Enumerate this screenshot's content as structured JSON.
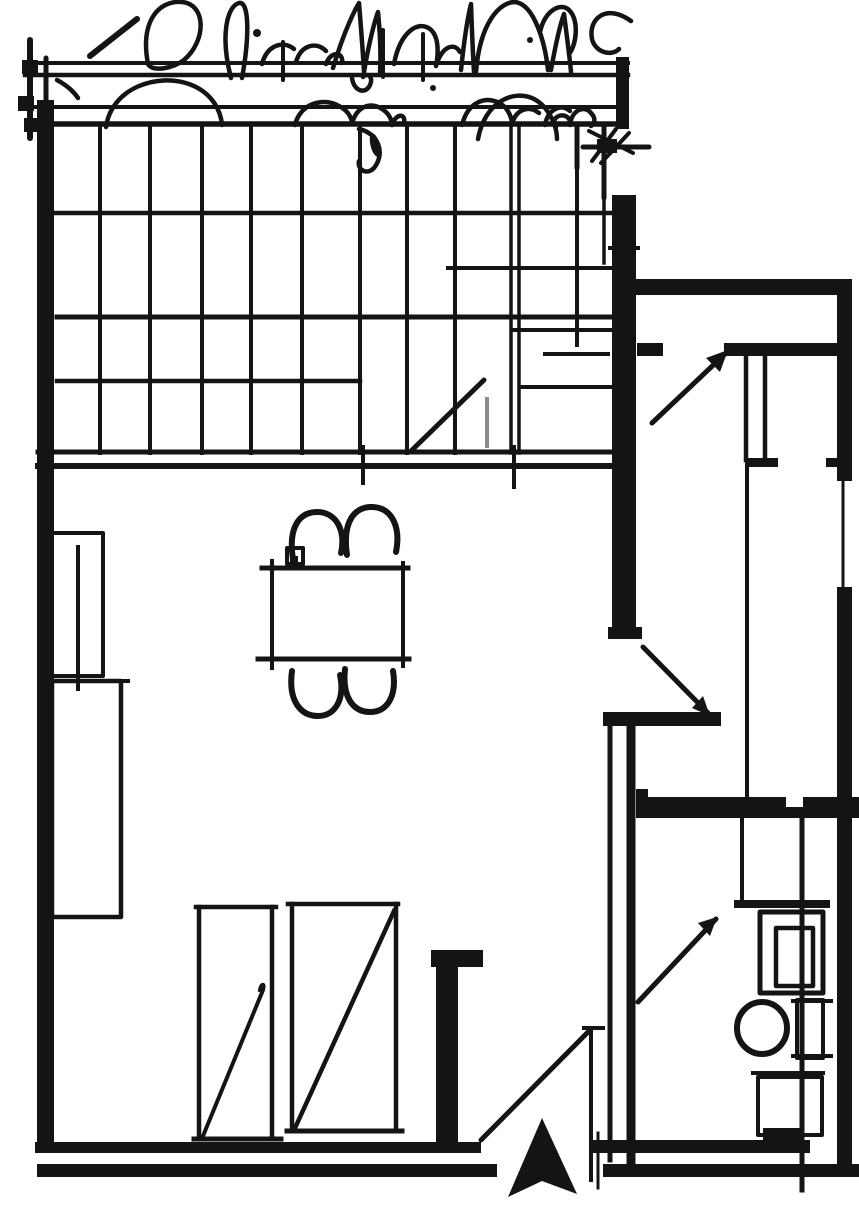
{
  "meta": {
    "title": "hand-drawn architectural floor plan sketch",
    "width_px": 859,
    "height_px": 1205,
    "drawing_style": "black ink / photocopy, freehand over straightedge"
  },
  "palette": {
    "background": "#ffffff",
    "ink": "#141414",
    "faded_ink": "#8a8a8a"
  },
  "plan": {
    "zones": [
      {
        "name": "planting-sketch",
        "desc": "freehand tree and shrub canopy scribbles along the top edge"
      },
      {
        "name": "pergola-beams",
        "desc": "two horizontal double-line beams below the planting"
      },
      {
        "name": "deck-grid",
        "desc": "gridded terrace/deck of roughly 9 columns by 4 rows"
      },
      {
        "name": "main-room",
        "desc": "large living/dining room with dining set, wardrobes and kitchen counters"
      },
      {
        "name": "side-wing",
        "desc": "right-hand wing with corridor, built-in closet and rooms"
      },
      {
        "name": "bathroom",
        "desc": "bottom-right wet room with vanity sink, toilet and shower cabinet"
      }
    ],
    "furniture": [
      {
        "name": "dining-table",
        "shape": "rectangle",
        "chairs": 4
      },
      {
        "name": "wardrobe-left",
        "symbol": "tall rectangle with diagonal stroke"
      },
      {
        "name": "wardrobe-right",
        "symbol": "tall rectangle with full diagonal stroke"
      },
      {
        "name": "kitchen-counter-upper",
        "symbol": "narrow rectangle with center line on left wall"
      },
      {
        "name": "kitchen-counter-lower",
        "symbol": "tall rectangle on left wall"
      },
      {
        "name": "column-pillar",
        "symbol": "solid filled post with cap"
      },
      {
        "name": "closet-double-lines",
        "symbol": "two parallel strokes with end tick"
      },
      {
        "name": "sink-vanity",
        "symbol": "nested rectangles"
      },
      {
        "name": "toilet",
        "symbol": "ellipse bowl with rectangular tank"
      },
      {
        "name": "shower-cabinet",
        "symbol": "rectangle with smudge"
      }
    ],
    "symbols": [
      {
        "name": "north-arrow",
        "style": "solid concave triangle pointing up",
        "location": "bottom center at entry"
      },
      {
        "name": "entry-door-swing",
        "style": "straight diagonal leaf line"
      },
      {
        "name": "corridor-door-swing",
        "style": "diagonal with arrow barb"
      },
      {
        "name": "bathroom-door-swing",
        "style": "diagonal with arrow barb"
      },
      {
        "name": "deck-door-swing",
        "style": "diagonal with faded leaf line"
      },
      {
        "name": "direction-arrow",
        "style": "diagonal arrow in upper corridor"
      }
    ]
  }
}
